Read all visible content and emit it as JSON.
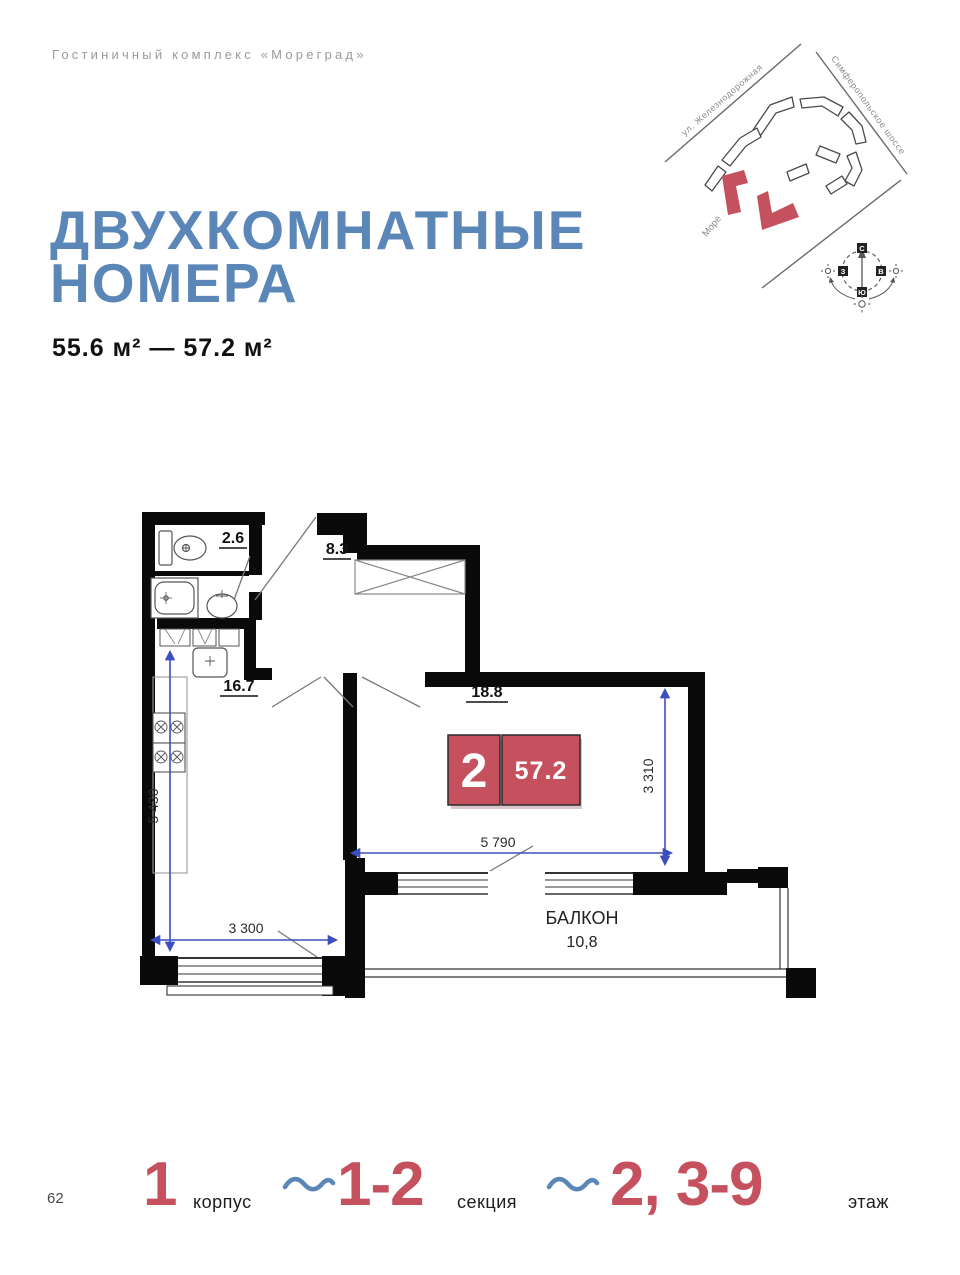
{
  "brand": "Гостиничный комплекс «Мореград»",
  "title": {
    "line1": "ДВУХКОМНАТНЫЕ",
    "line2": "НОМЕРА"
  },
  "area_range": "55.6 м² — 57.2 м²",
  "site_map": {
    "street_left": "ул. Железнодорожная",
    "street_right": "Симферопольское шоссе",
    "sea_label": "Море",
    "compass": {
      "n": "С",
      "s": "Ю",
      "w": "З",
      "e": "В"
    }
  },
  "plan": {
    "rooms": {
      "wc_area": "2.6",
      "hall_area": "8.3",
      "kitchen_area": "16.7",
      "bedroom_area": "18.8",
      "balcony_label": "БАЛКОН",
      "balcony_area": "10,8"
    },
    "badge": {
      "room_count": "2",
      "total_area": "57.2"
    },
    "dims": {
      "left_height": "5 430",
      "left_width": "3 300",
      "bedroom_width": "5 790",
      "bedroom_height": "3 310"
    }
  },
  "footer": {
    "page_number": "62",
    "korpus_value": "1",
    "korpus_label": "корпус",
    "section_value": "1-2",
    "section_label": "секция",
    "floor_value": "2, 3-9",
    "floor_label": "этаж"
  },
  "colors": {
    "accent_blue": "#5b86b8",
    "accent_red": "#c5505e",
    "dimension_blue": "#3d4fc0",
    "brand_gray": "#9b9b9b"
  }
}
